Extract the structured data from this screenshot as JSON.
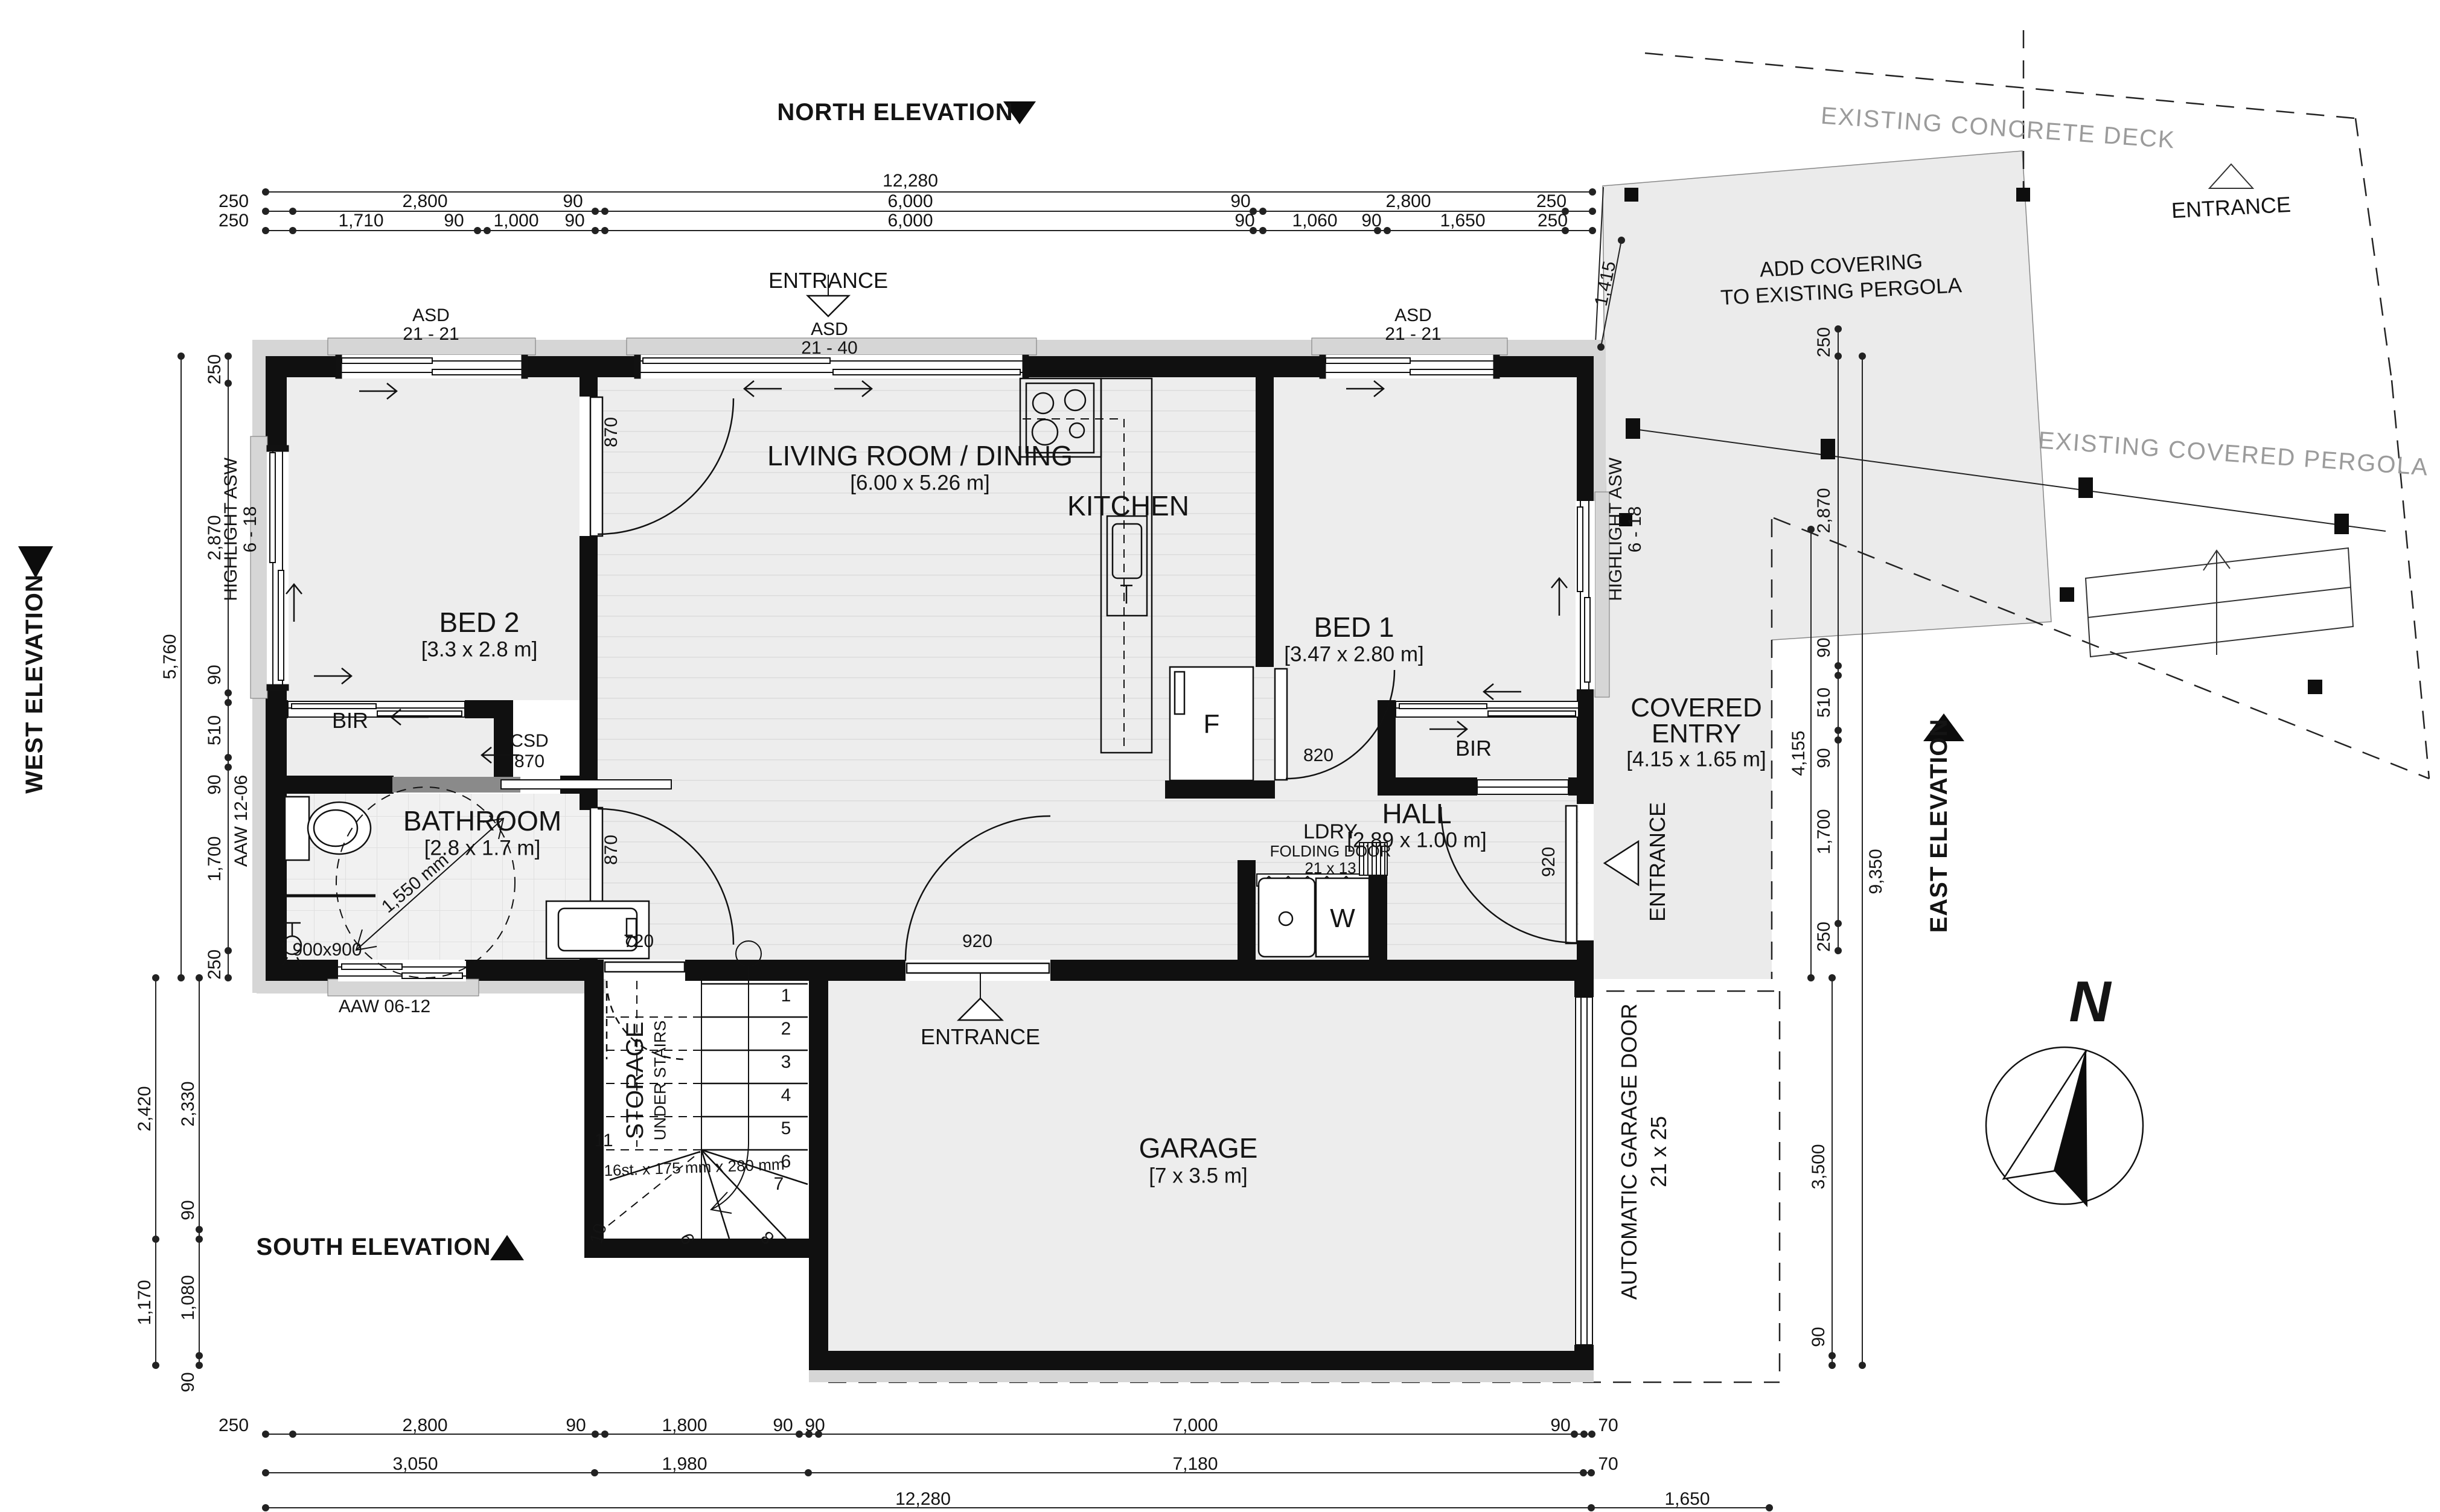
{
  "elevations": {
    "north": "NORTH ELEVATION",
    "west": "WEST ELEVATION",
    "south": "SOUTH ELEVATION",
    "east": "EAST ELEVATION"
  },
  "site": {
    "deck": "EXISTING CONCRETE DECK",
    "pergola": "EXISTING COVERED PERGOLA",
    "add_covering_l1": "ADD COVERING",
    "add_covering_l2": "TO EXISTING PERGOLA",
    "entrance": "ENTRANCE"
  },
  "rooms": {
    "living": {
      "name": "LIVING ROOM / DINING",
      "size": "[6.00 x 5.26 m]"
    },
    "kitchen": {
      "name": "KITCHEN"
    },
    "bed1": {
      "name": "BED 1",
      "size": "[3.47 x 2.80 m]"
    },
    "bed2": {
      "name": "BED 2",
      "size": "[3.3 x 2.8 m]"
    },
    "bathroom": {
      "name": "BATHROOM",
      "size": "[2.8 x 1.7 m]"
    },
    "hall": {
      "name": "HALL",
      "size": "[2.89 x 1.00 m]"
    },
    "garage": {
      "name": "GARAGE",
      "size": "[7 x 3.5 m]"
    },
    "covered_entry": {
      "l1": "COVERED",
      "l2": "ENTRY",
      "size": "[4.15 x 1.65 m]"
    },
    "bir": "BIR",
    "storage": {
      "l1": "STORAGE",
      "l2": "UNDER STAIRS"
    },
    "ldry": {
      "l1": "LDRY",
      "l2": "FOLDING DOOR",
      "l3": "21 x 13"
    }
  },
  "windows": {
    "asd": "ASD",
    "size_2121": "21 - 21",
    "size_2140": "21 - 40",
    "highlight": "HIGHLIGHT ASW",
    "highlight_size": "6 - 18",
    "aaw_west": "AAW 12-06",
    "aaw_south": "AAW 06-12"
  },
  "doors": {
    "d870": "870",
    "d820": "820",
    "d920": "920",
    "d720": "720",
    "csd": "CSD",
    "garage_door_l1": "AUTOMATIC GARAGE DOOR",
    "garage_door_l2": "21 x 25"
  },
  "fixtures": {
    "fridge": "F",
    "washer": "W",
    "shower": "900x900",
    "turning_circle": "1,550 mm"
  },
  "stairs": {
    "note": "16st. x 175 mm x 280 mm",
    "n": [
      "1",
      "2",
      "3",
      "4",
      "5",
      "6",
      "7",
      "8",
      "9",
      "10",
      "11"
    ]
  },
  "compass": {
    "north": "N"
  },
  "dims": {
    "top": {
      "overall": "12,280",
      "row2": [
        "250",
        "2,800",
        "90",
        "6,000",
        "90",
        "2,800",
        "250"
      ],
      "row3": [
        "250",
        "1,710",
        "90",
        "1,000",
        "90",
        "6,000",
        "90",
        "1,060",
        "90",
        "1,650",
        "250"
      ]
    },
    "left": {
      "overall": "5,760",
      "chain": [
        "250",
        "2,870",
        "90",
        "510",
        "90",
        "1,700",
        "250"
      ],
      "lower": [
        "2,420",
        "2,330",
        "90",
        "1,170",
        "1,080",
        "90"
      ]
    },
    "bottom": {
      "row1": [
        "250",
        "2,800",
        "90",
        "1,800",
        "90",
        "90",
        "7,000",
        "90",
        "70"
      ],
      "row2": [
        "3,050",
        "1,980",
        "7,180",
        "70"
      ],
      "row3": [
        "12,280",
        "1,650"
      ]
    },
    "right": {
      "chain": [
        "250",
        "2,870",
        "90",
        "510",
        "90",
        "1,700",
        "250"
      ],
      "d4155": "4,155",
      "d9350": "9,350",
      "d3500": "3,500",
      "d90": "90",
      "d1415": "1,415"
    }
  }
}
